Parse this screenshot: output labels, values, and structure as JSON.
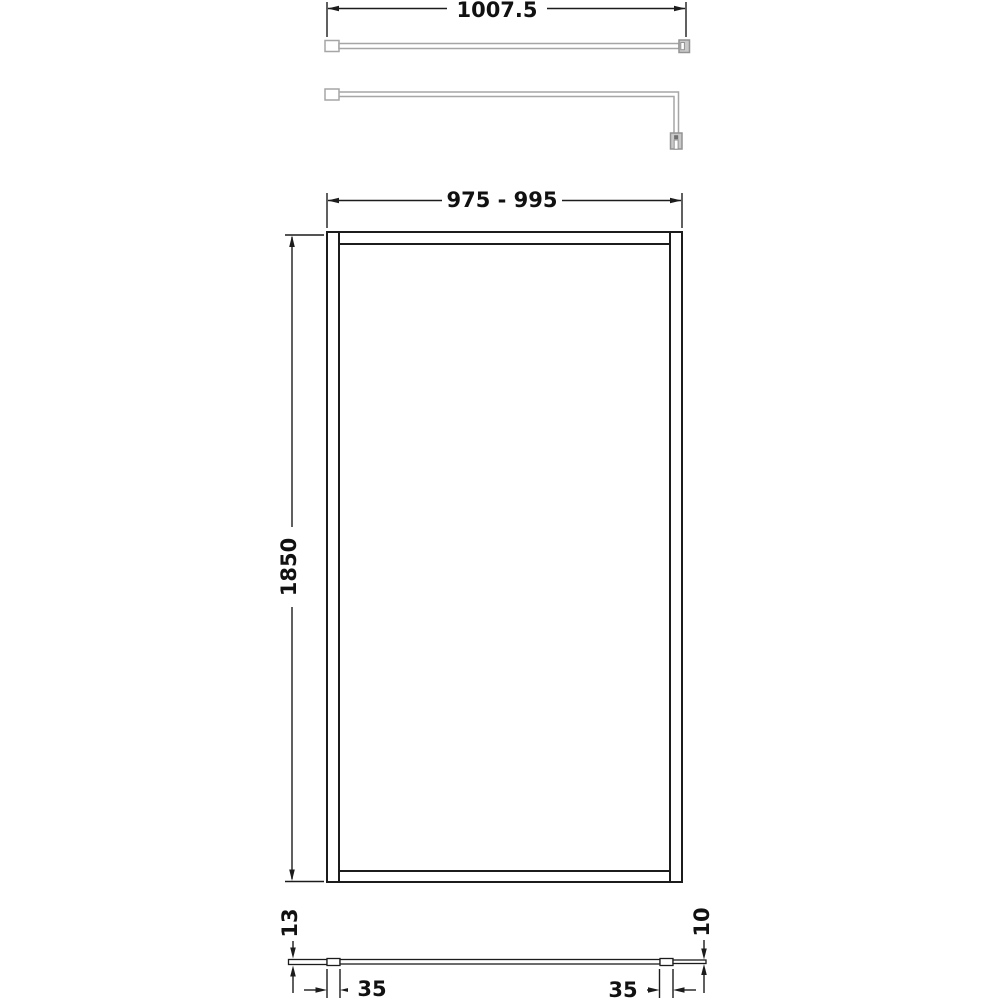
{
  "drawing": {
    "type": "technical-dimension-drawing",
    "views": {
      "support_bar_plan": {
        "description": "support bar top view",
        "length_label": "1007.5"
      },
      "panel_front": {
        "description": "shower screen front elevation",
        "width_range_label": "975 - 995",
        "height_label": "1850"
      },
      "panel_bottom": {
        "description": "panel bottom section view",
        "left_thickness_label": "13",
        "right_thickness_label": "10",
        "left_profile_width_label": "35",
        "right_profile_width_label": "35"
      }
    },
    "colors": {
      "line": "#1c1c1c",
      "support_outline": "#a6a6a6",
      "support_fill": "#c9c9c9",
      "background": "#ffffff"
    }
  }
}
